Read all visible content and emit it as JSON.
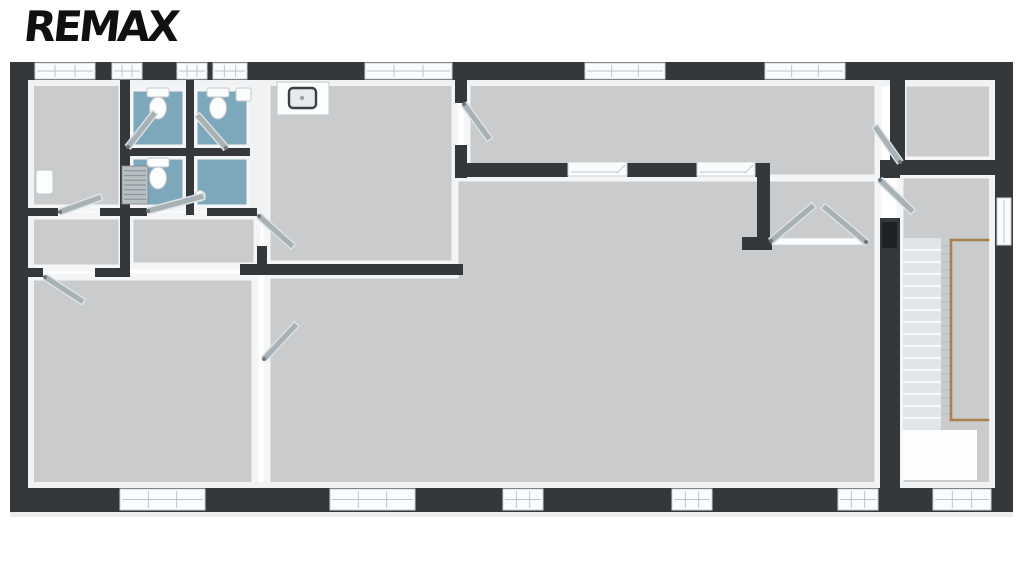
{
  "logo": {
    "text": "REMAX"
  },
  "palette": {
    "wall_dark": "#35383b",
    "wall_dark_door": "#1e2124",
    "wall_white": "#f0f2f3",
    "floor_gray": "#c9cbcc",
    "floor_blue": "#7da7bb",
    "floor_trim": "#f4f5f6",
    "door_gray": "#a7b1b6",
    "door_edge": "#dde2e5",
    "window_white": "#fafbfc",
    "window_frame": "#cfd3d5",
    "window_line": "#c0c5c8",
    "stair_tread": "#e2e5e7",
    "stair_line": "#ffffff",
    "rail_wood": "#a9824d",
    "baluster": "#b9bec2",
    "fixture_white": "#fcfdfd",
    "fixture_stroke": "#c2c8cb",
    "sink_steel": "#e8ebed",
    "sink_rim": "#3a3f42",
    "radiator_fill": "#b9c0c4",
    "radiator_line": "#8d969b",
    "shadow": "#ececed"
  },
  "plan": {
    "canvas": {
      "w": 1024,
      "h": 576
    },
    "floors": [
      {
        "n": "floor-office",
        "r": [
          28,
          80,
          94,
          128
        ],
        "fill": "gray"
      },
      {
        "n": "floor-wc-1",
        "r": [
          130,
          88,
          56,
          60
        ],
        "fill": "blue"
      },
      {
        "n": "floor-wc-2",
        "r": [
          194,
          88,
          56,
          60
        ],
        "fill": "blue"
      },
      {
        "n": "floor-wc-3",
        "r": [
          130,
          156,
          56,
          52
        ],
        "fill": "blue"
      },
      {
        "n": "floor-wc-4",
        "r": [
          194,
          156,
          56,
          52
        ],
        "fill": "blue"
      },
      {
        "n": "floor-corridor-left",
        "r": [
          28,
          216,
          94,
          52
        ],
        "fill": "gray"
      },
      {
        "n": "floor-corridor",
        "r": [
          130,
          216,
          127,
          50
        ],
        "fill": "gray"
      },
      {
        "n": "floor-kitchen",
        "r": [
          267,
          80,
          188,
          184
        ],
        "fill": "gray"
      },
      {
        "n": "floor-room-bottom-left",
        "r": [
          28,
          277,
          227,
          211
        ],
        "fill": "gray"
      },
      {
        "n": "floor-north-room",
        "r": [
          467,
          80,
          411,
          98
        ],
        "fill": "gray"
      },
      {
        "n": "floor-stair-hall",
        "r": [
          900,
          175,
          95,
          313
        ],
        "fill": "gray"
      },
      {
        "n": "floor-top-right-room",
        "r": [
          903,
          83,
          90,
          77
        ],
        "fill": "gray"
      }
    ],
    "main_hall_polygon": {
      "n": "floor-main-hall",
      "points": "455,178 878,178 878,488 267,488 267,275 455,275"
    },
    "walls": [
      {
        "n": "outer-wall-top",
        "r": [
          10,
          62,
          1003,
          18
        ]
      },
      {
        "n": "outer-wall-bottom",
        "r": [
          10,
          488,
          1003,
          24
        ]
      },
      {
        "n": "outer-wall-left",
        "r": [
          10,
          62,
          18,
          450
        ]
      },
      {
        "n": "outer-wall-right",
        "r": [
          995,
          62,
          18,
          450
        ]
      },
      {
        "n": "wall-office-wc",
        "r": [
          120,
          80,
          10,
          190
        ]
      },
      {
        "n": "wall-wc-divider-v",
        "r": [
          186,
          80,
          8,
          135
        ]
      },
      {
        "n": "wall-wc-divider-h",
        "r": [
          120,
          148,
          130,
          8
        ]
      },
      {
        "n": "wall-office-south-a",
        "r": [
          10,
          208,
          48,
          8
        ]
      },
      {
        "n": "wall-office-south-b",
        "r": [
          100,
          208,
          30,
          8
        ]
      },
      {
        "n": "wall-corridor-south-a",
        "r": [
          10,
          268,
          33,
          9
        ]
      },
      {
        "n": "wall-corridor-south-b",
        "r": [
          95,
          268,
          35,
          9
        ]
      },
      {
        "n": "wall-wc-south-a",
        "r": [
          120,
          208,
          27,
          8
        ]
      },
      {
        "n": "wall-wc-south-b",
        "r": [
          207,
          208,
          50,
          8
        ]
      },
      {
        "n": "wall-kitchen-south",
        "r": [
          240,
          264,
          223,
          11
        ]
      },
      {
        "n": "wall-corridor-east",
        "r": [
          257,
          246,
          10,
          20
        ]
      },
      {
        "n": "wall-kitchen-east-a",
        "r": [
          455,
          80,
          12,
          23
        ]
      },
      {
        "n": "wall-kitchen-east-b",
        "r": [
          455,
          145,
          12,
          33
        ]
      },
      {
        "n": "wall-north-room-south-a",
        "r": [
          467,
          163,
          101,
          14
        ]
      },
      {
        "n": "wall-north-room-south-b",
        "r": [
          627,
          163,
          70,
          14
        ]
      },
      {
        "n": "wall-north-room-south-c",
        "r": [
          755,
          163,
          15,
          14
        ]
      },
      {
        "n": "wall-vestibule-west",
        "r": [
          757,
          163,
          13,
          80
        ]
      },
      {
        "n": "wall-vestibule-stub",
        "r": [
          742,
          237,
          30,
          13
        ]
      },
      {
        "n": "wall-stair-hall-west-a",
        "r": [
          880,
          160,
          20,
          18
        ]
      },
      {
        "n": "wall-stair-hall-west-b",
        "r": [
          880,
          218,
          20,
          270
        ]
      },
      {
        "n": "wall-top-right-west",
        "r": [
          890,
          62,
          15,
          100
        ]
      },
      {
        "n": "wall-top-right-south",
        "r": [
          890,
          160,
          123,
          15
        ]
      }
    ],
    "white_walls": [
      {
        "n": "wall-wc-east-face",
        "r": [
          250,
          80,
          17,
          135
        ]
      },
      {
        "n": "wall-face-top",
        "r": [
          28,
          80,
          967,
          6
        ]
      },
      {
        "n": "wall-face-left",
        "r": [
          28,
          80,
          6,
          408
        ]
      },
      {
        "n": "wall-face-bottom",
        "r": [
          28,
          482,
          967,
          6
        ]
      },
      {
        "n": "wall-face-right",
        "r": [
          989,
          80,
          6,
          408
        ]
      }
    ],
    "windows_h": [
      {
        "n": "window-top-1",
        "r": [
          35,
          63,
          60,
          16
        ]
      },
      {
        "n": "window-top-2",
        "r": [
          112,
          63,
          30,
          16
        ]
      },
      {
        "n": "window-top-3",
        "r": [
          177,
          63,
          30,
          16
        ]
      },
      {
        "n": "window-top-4",
        "r": [
          213,
          63,
          34,
          16
        ]
      },
      {
        "n": "window-top-5",
        "r": [
          365,
          63,
          87,
          16
        ]
      },
      {
        "n": "window-top-6",
        "r": [
          585,
          63,
          80,
          16
        ]
      },
      {
        "n": "window-top-7",
        "r": [
          765,
          63,
          80,
          16
        ]
      },
      {
        "n": "window-bottom-1",
        "r": [
          120,
          489,
          85,
          21
        ]
      },
      {
        "n": "window-bottom-2",
        "r": [
          330,
          489,
          85,
          21
        ]
      },
      {
        "n": "window-bottom-3",
        "r": [
          503,
          489,
          40,
          21
        ]
      },
      {
        "n": "window-bottom-4",
        "r": [
          672,
          489,
          40,
          21
        ]
      },
      {
        "n": "window-bottom-5",
        "r": [
          838,
          489,
          40,
          21
        ]
      },
      {
        "n": "entrance-opening",
        "r": [
          933,
          489,
          58,
          21
        ]
      }
    ],
    "windows_v": [
      {
        "n": "window-right-1",
        "r": [
          997,
          198,
          14,
          47
        ]
      }
    ],
    "slide_openings": [
      {
        "n": "sliding-partition-1",
        "r": [
          568,
          162,
          59,
          14
        ]
      },
      {
        "n": "sliding-partition-2",
        "r": [
          697,
          162,
          58,
          14
        ]
      }
    ],
    "threshold": {
      "n": "double-door-threshold",
      "r": [
        772,
        238,
        94,
        7
      ]
    },
    "doors": [
      {
        "n": "door-office",
        "h": [
          60,
          212
        ],
        "a": -20,
        "l": 44
      },
      {
        "n": "door-wc-3",
        "h": [
          148,
          211
        ],
        "a": -15,
        "l": 58
      },
      {
        "n": "door-wc-1",
        "h": [
          128,
          147
        ],
        "a": -52,
        "l": 44
      },
      {
        "n": "door-wc-2",
        "h": [
          226,
          148
        ],
        "a": -131,
        "l": 44
      },
      {
        "n": "door-corridor-left",
        "h": [
          45,
          277
        ],
        "a": 33,
        "l": 46
      },
      {
        "n": "door-corridor-kitchen",
        "h": [
          259,
          216
        ],
        "a": 42,
        "l": 46
      },
      {
        "n": "door-kitchen-north",
        "h": [
          464,
          104
        ],
        "a": 54,
        "l": 44
      },
      {
        "n": "door-main-hall-west",
        "h": [
          264,
          359
        ],
        "a": -47,
        "l": 48
      },
      {
        "n": "double-door-left",
        "h": [
          771,
          241
        ],
        "a": -40,
        "l": 56
      },
      {
        "n": "double-door-right",
        "h": [
          866,
          242
        ],
        "a": -140,
        "l": 56
      },
      {
        "n": "door-stair-hall",
        "h": [
          880,
          180
        ],
        "a": 44,
        "l": 46
      },
      {
        "n": "door-north-room-east",
        "h": [
          900,
          162
        ],
        "a": -125,
        "l": 44
      }
    ],
    "door_leaf_dark": {
      "n": "door-leaf-closed",
      "r": [
        882,
        222,
        15,
        26
      ]
    },
    "fixtures": {
      "kitchen_counter": {
        "n": "kitchen-counter",
        "r": [
          277,
          82,
          52,
          33
        ]
      },
      "kitchen_sink": {
        "n": "kitchen-sink",
        "r": [
          289,
          88,
          27,
          20
        ]
      },
      "faucet": {
        "n": "kitchen-faucet",
        "c": [
          302,
          86,
          3
        ]
      },
      "toilets": [
        {
          "n": "toilet-wc-1",
          "cx": 158,
          "top": 88
        },
        {
          "n": "toilet-wc-2",
          "cx": 218,
          "top": 88
        },
        {
          "n": "toilet-wc-3",
          "cx": 158,
          "top": 158
        }
      ],
      "basin_wc2": {
        "n": "hand-basin-wc-2",
        "r": [
          236,
          88,
          15,
          13
        ]
      },
      "basin_wc4": {
        "n": "hand-basin-wc-4",
        "c": [
          200,
          196,
          5.5
        ]
      },
      "radiator": {
        "n": "radiator",
        "r": [
          122,
          166,
          26,
          38
        ],
        "lines": 7
      },
      "panel_box": {
        "n": "wall-panel-box",
        "r": [
          36,
          170,
          17,
          24
        ]
      }
    },
    "stairs": {
      "n": "staircase",
      "steps": {
        "r": [
          903,
          238,
          38,
          192
        ],
        "count": 16
      },
      "landing": {
        "r": [
          903,
          430,
          74,
          50
        ]
      },
      "rail": {
        "n": "stair-railing",
        "vertical": [
          951,
          240,
          951,
          420
        ],
        "top_h": [
          951,
          240,
          988,
          240
        ],
        "bottom_h": [
          951,
          420,
          988,
          420
        ],
        "balusters": {
          "x1": 941,
          "x2": 951,
          "y_from": 246,
          "y_to": 414,
          "step": 8
        }
      }
    },
    "shadow": {
      "r": [
        10,
        512,
        1003,
        5
      ]
    }
  }
}
